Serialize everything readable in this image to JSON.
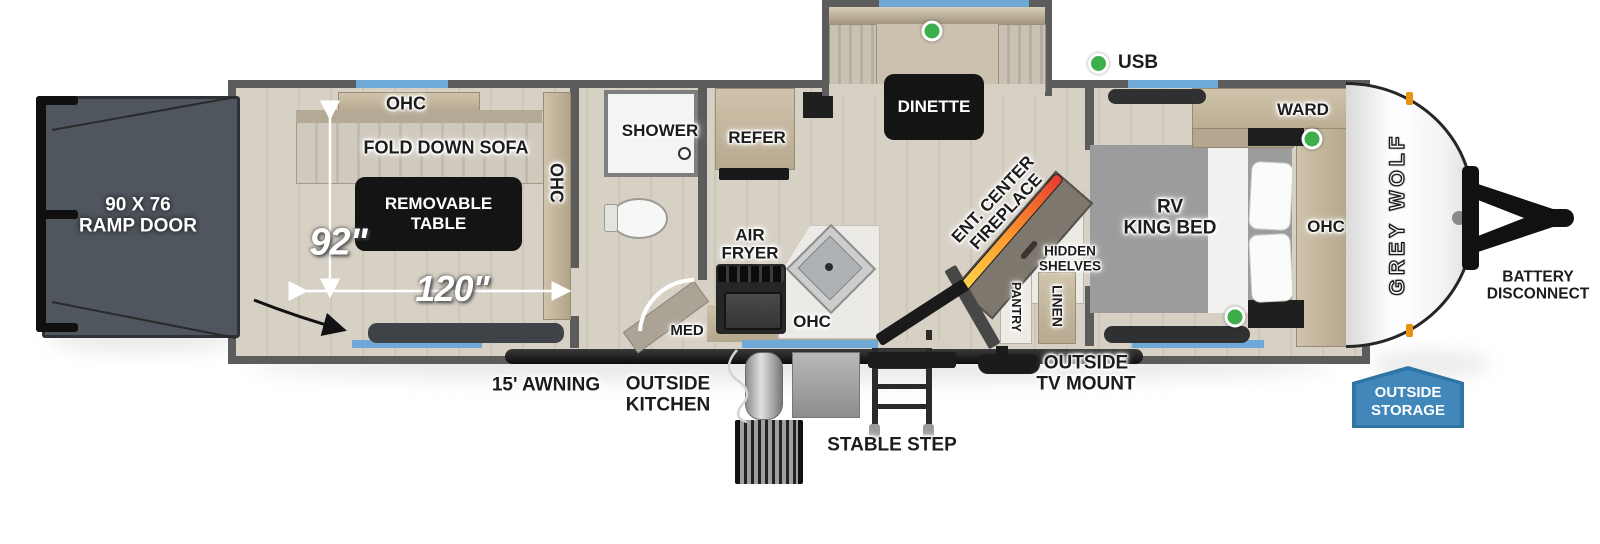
{
  "floorplan": {
    "brand": "GREY WOLF",
    "legend_usb": "USB",
    "labels": {
      "ramp_door": "90 X 76\nRAMP DOOR",
      "ohc": "OHC",
      "fold_down_sofa": "FOLD DOWN SOFA",
      "removable_table": "REMOVABLE\nTABLE",
      "dim_width": "92\"",
      "dim_length": "120\"",
      "shower": "SHOWER",
      "med": "MED",
      "refer": "REFER",
      "air_fryer": "AIR\nFRYER",
      "dinette": "DINETTE",
      "ent_center_fireplace": "ENT. CENTER\nFIREPLACE",
      "hidden_shelves": "HIDDEN\nSHELVES",
      "pantry": "PANTRY",
      "linen": "LINEN",
      "rv_king_bed": "RV\nKING BED",
      "ward": "WARD",
      "battery_disconnect": "BATTERY\nDISCONNECT",
      "awning": "15' AWNING",
      "outside_kitchen": "OUTSIDE\nKITCHEN",
      "stable_step": "STABLE STEP",
      "outside_tv_mount": "OUTSIDE\nTV MOUNT",
      "outside_storage": "OUTSIDE\nSTORAGE"
    },
    "colors": {
      "accent_blue": "#6FA9D8",
      "badge_blue": "#4187BA",
      "badge_blue_dark": "#2E74A4",
      "usb_green": "#3CAE4A",
      "wall_gray": "#5C5C5C",
      "floor": "#D6CFC4",
      "table_black": "#141414",
      "ramp_gray": "#50565E",
      "wood": "#BBAE98",
      "marker_orange": "#E8920F"
    }
  }
}
